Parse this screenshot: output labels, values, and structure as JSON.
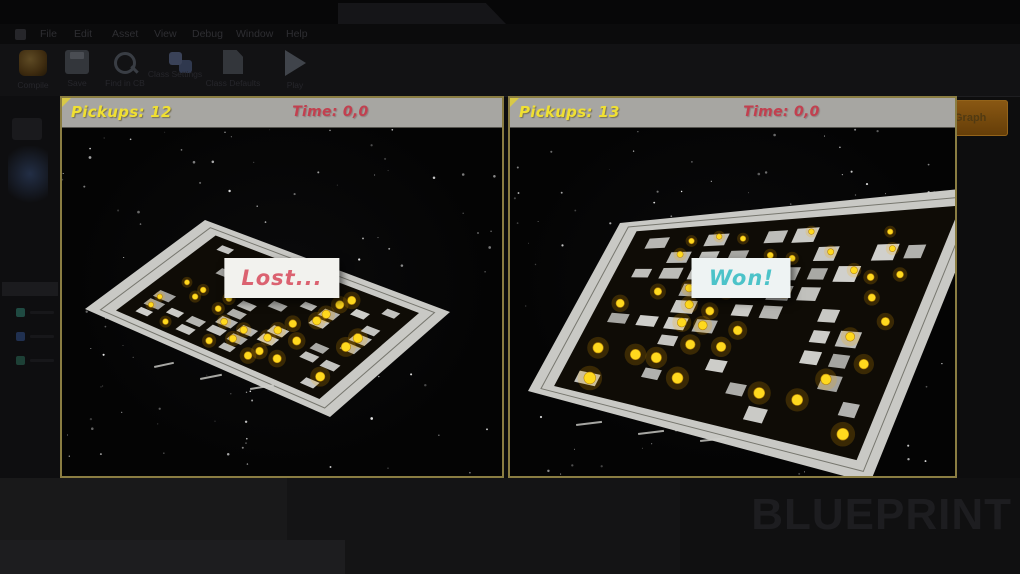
{
  "editor": {
    "menu": [
      "File",
      "Edit",
      "Asset",
      "View",
      "Debug",
      "Window",
      "Help"
    ],
    "toolbar": {
      "items": [
        {
          "name": "compile",
          "label": "Compile"
        },
        {
          "name": "save",
          "label": "Save"
        },
        {
          "name": "find",
          "label": "Find in CB"
        },
        {
          "name": "class-settings",
          "label": "Class Settings"
        },
        {
          "name": "class-defaults",
          "label": "Class Defaults"
        },
        {
          "name": "play",
          "label": "Play"
        }
      ],
      "debug_filter_label": "Debug Filter",
      "breadcrumb": {
        "defaults": "Defaults",
        "components": "Components",
        "graph": "Graph"
      }
    },
    "watermark": "BLUEPRINT"
  },
  "viewports": [
    {
      "id": "left",
      "pickups": "Pickups: 12",
      "time": "Time: 0,0",
      "message": "Lost...",
      "message_color": "#db6270"
    },
    {
      "id": "right",
      "pickups": "Pickups: 13",
      "time": "Time: 0,0",
      "message": "Won!",
      "message_color": "#4cc3c9"
    }
  ],
  "colors": {
    "viewport_border": "#8a7d42",
    "hud_bar": "#a7a6a2",
    "pickups_text": "#f0e032",
    "time_text": "#c2404f",
    "pickup_item": "#ffd91e",
    "platform_frame": "#c9c9c5",
    "graph_button": "#7c4d10"
  }
}
